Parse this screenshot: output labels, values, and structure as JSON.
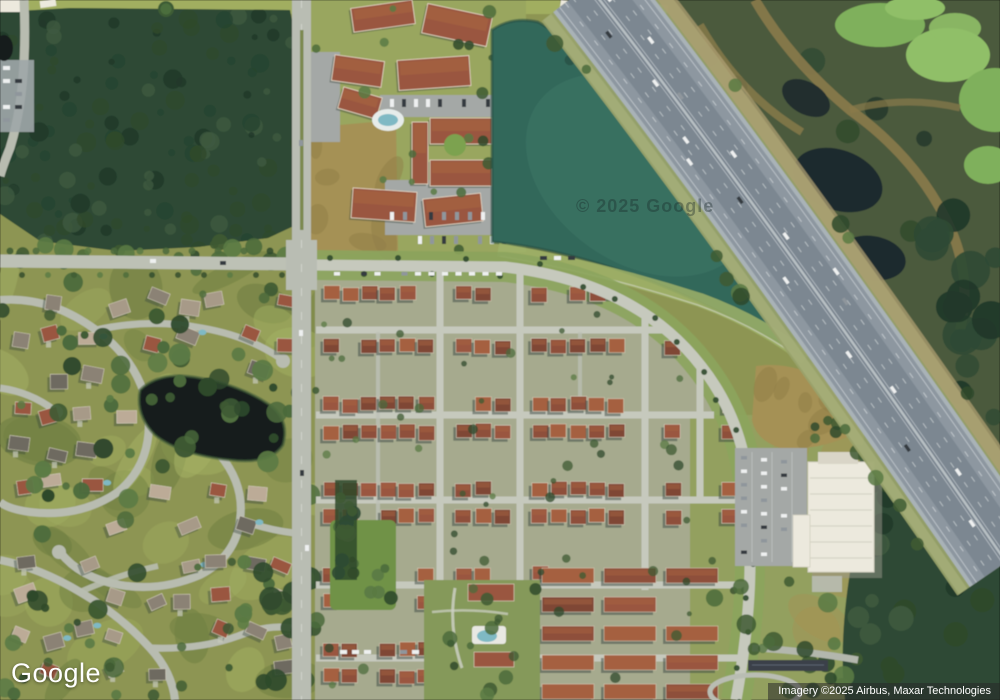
{
  "map": {
    "view_mode": "satellite",
    "watermark": "© 2025 Google",
    "logo_text": "Google",
    "attribution_text": "Imagery ©2025 Airbus, Maxar Technologies"
  },
  "features": [
    {
      "name": "forest-northwest"
    },
    {
      "name": "apartment-complex-north"
    },
    {
      "name": "retention-pond"
    },
    {
      "name": "highway-toll-road"
    },
    {
      "name": "wetland-northeast"
    },
    {
      "name": "suburb-neighborhood-west"
    },
    {
      "name": "townhome-community-center"
    },
    {
      "name": "school-campus-southeast"
    },
    {
      "name": "main-road-vertical"
    },
    {
      "name": "main-road-horizontal"
    }
  ],
  "palette": {
    "suburb_base": "#8d9552",
    "lawn_light": "#a3b063",
    "lawn_dark": "#6f7f42",
    "street": "#b8bcb0",
    "street_light": "#c9ccc1",
    "forest": "#2e4a34",
    "forest_dark": "#20372a",
    "forest_light": "#3e5a40",
    "dev_base": "#a6aa8e",
    "dev_street": "#c6c9bd",
    "roof_red_1": "#8e4f3a",
    "roof_red_2": "#9a5740",
    "roof_red_3": "#a5613f",
    "roof_red_4": "#7f4634",
    "roof_gray_1": "#8b8274",
    "roof_gray_2": "#a79a88",
    "roof_gray_3": "#6e6a60",
    "roof_gray_4": "#bcab97",
    "shadow": "#3a463f",
    "pond": "#33685a",
    "pond_light": "#3f7a68",
    "pond_dark": "#234a41",
    "small_pond": "#151f1d",
    "highway_outer": "#a9b2b7",
    "highway_asphalt": "#8d97a0",
    "highway_lane": "#79848e",
    "highway_line": "#eef2f3",
    "embankment": "#99a26b",
    "embankment_tan": "#ad9f72",
    "wetland": "#4b5a3d",
    "algae": "#7fb05b",
    "algae_light": "#90bf68",
    "marsh_trail": "#8a7a4a",
    "marsh_water": "#1d2a2e",
    "field_tan": "#a59155",
    "field_tan_dark": "#8f7d48",
    "building_white": "#ece9dd",
    "building_line": "#d2cfc0",
    "parking": "#a4a8a6",
    "pool_aqua": "#7fb9c4",
    "car_white": "#eef0f0",
    "car_dark": "#343b41",
    "car_gray": "#8f969c",
    "tree_1": "#3e5a33",
    "tree_2": "#4c6b3c",
    "tree_3": "#2f4a2c",
    "tree_4": "#5a7a44"
  }
}
